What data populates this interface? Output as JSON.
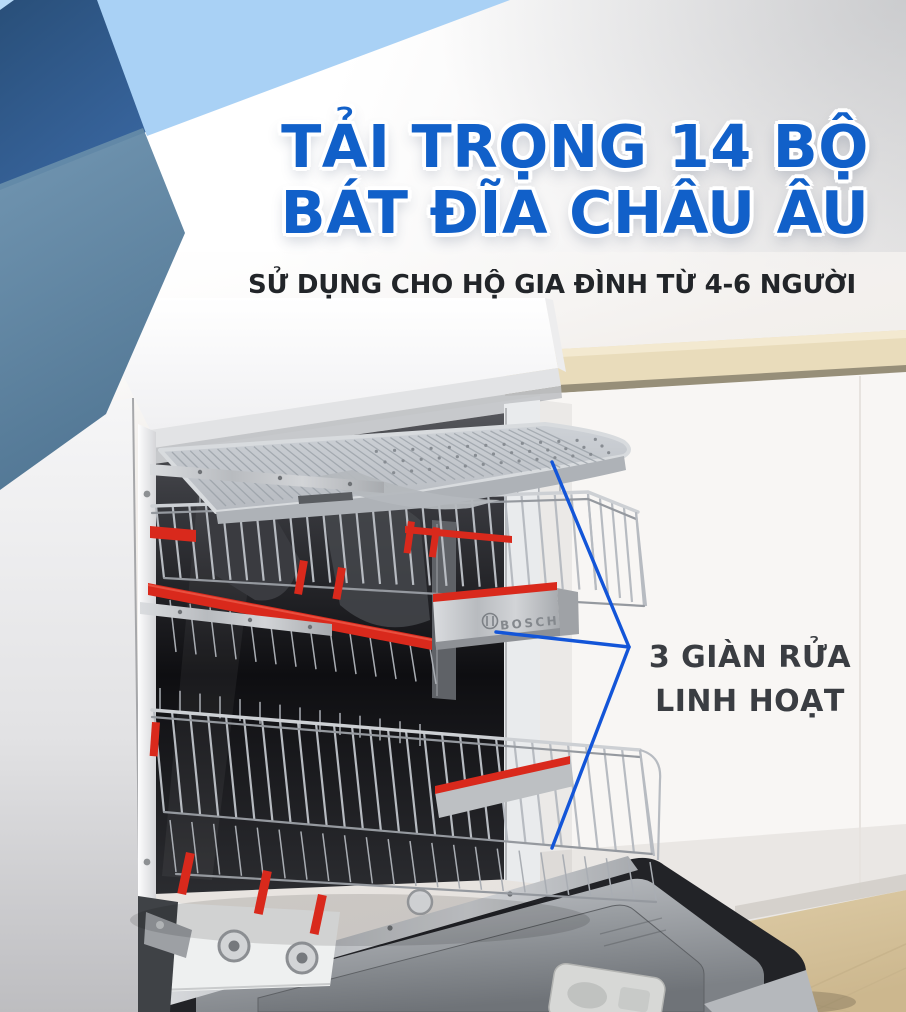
{
  "hero": {
    "title_line1": "TẢI TRỌNG 14 BỘ",
    "title_line2": "BÁT ĐĨA CHÂU ÂU",
    "subtitle": "SỬ DỤNG CHO HỘ GIA ĐÌNH TỪ 4-6 NGƯỜI"
  },
  "callout": {
    "line1": "3 GIÀN RỬA",
    "line2": "LINH HOẠT"
  },
  "product": {
    "brand": "BOSCH"
  },
  "colors": {
    "title_blue": "#1160c9",
    "subtitle_dark": "#222529",
    "annotation_dark": "#3a3d42",
    "callout_line_blue": "#1355d8",
    "accent_red": "#d9291c",
    "shape_dark_blue": "#2d5c8f",
    "shape_light_blue": "#a9d1f5",
    "shape_steel_blue": "#53799d",
    "counter_beige": "#e9dcbb",
    "wood_floor": "#d7c49c"
  }
}
